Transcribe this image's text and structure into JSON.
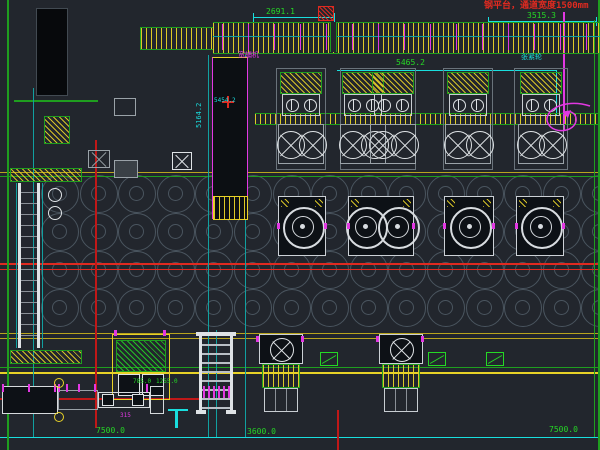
{
  "drawing": {
    "notes": {
      "platform_note": "钢平台，通道宽度1500mm"
    },
    "labels": {
      "tension_wheel": "张紧轮",
      "machine_label": "宽辅机"
    },
    "dimensions": {
      "top_center": "2691.1",
      "top_right": "3515.3",
      "mid_right": "5465.2",
      "left_vertical": "5164.2",
      "conveyor_inner": "5454.2",
      "bottom_left": "7500.0",
      "bottom_center": "3600.0",
      "bottom_right": "7500.0",
      "small_left_a": "785.0",
      "small_left_b": "1255.0",
      "small_315": "315"
    },
    "colors": {
      "background": "#22262d",
      "yellow": "#e8d227",
      "dim_yellow": "#b8a41e",
      "orange": "#d9821e",
      "green": "#25d825",
      "dim_green": "#1f9e1f",
      "cyan": "#19dede",
      "dim_cyan": "#11a0a0",
      "red": "#e02a20",
      "dark_red": "#c01818",
      "magenta": "#e238e2",
      "white": "#dfe3e6",
      "gray": "#9aa2a8",
      "coil": "#4a555f"
    }
  }
}
